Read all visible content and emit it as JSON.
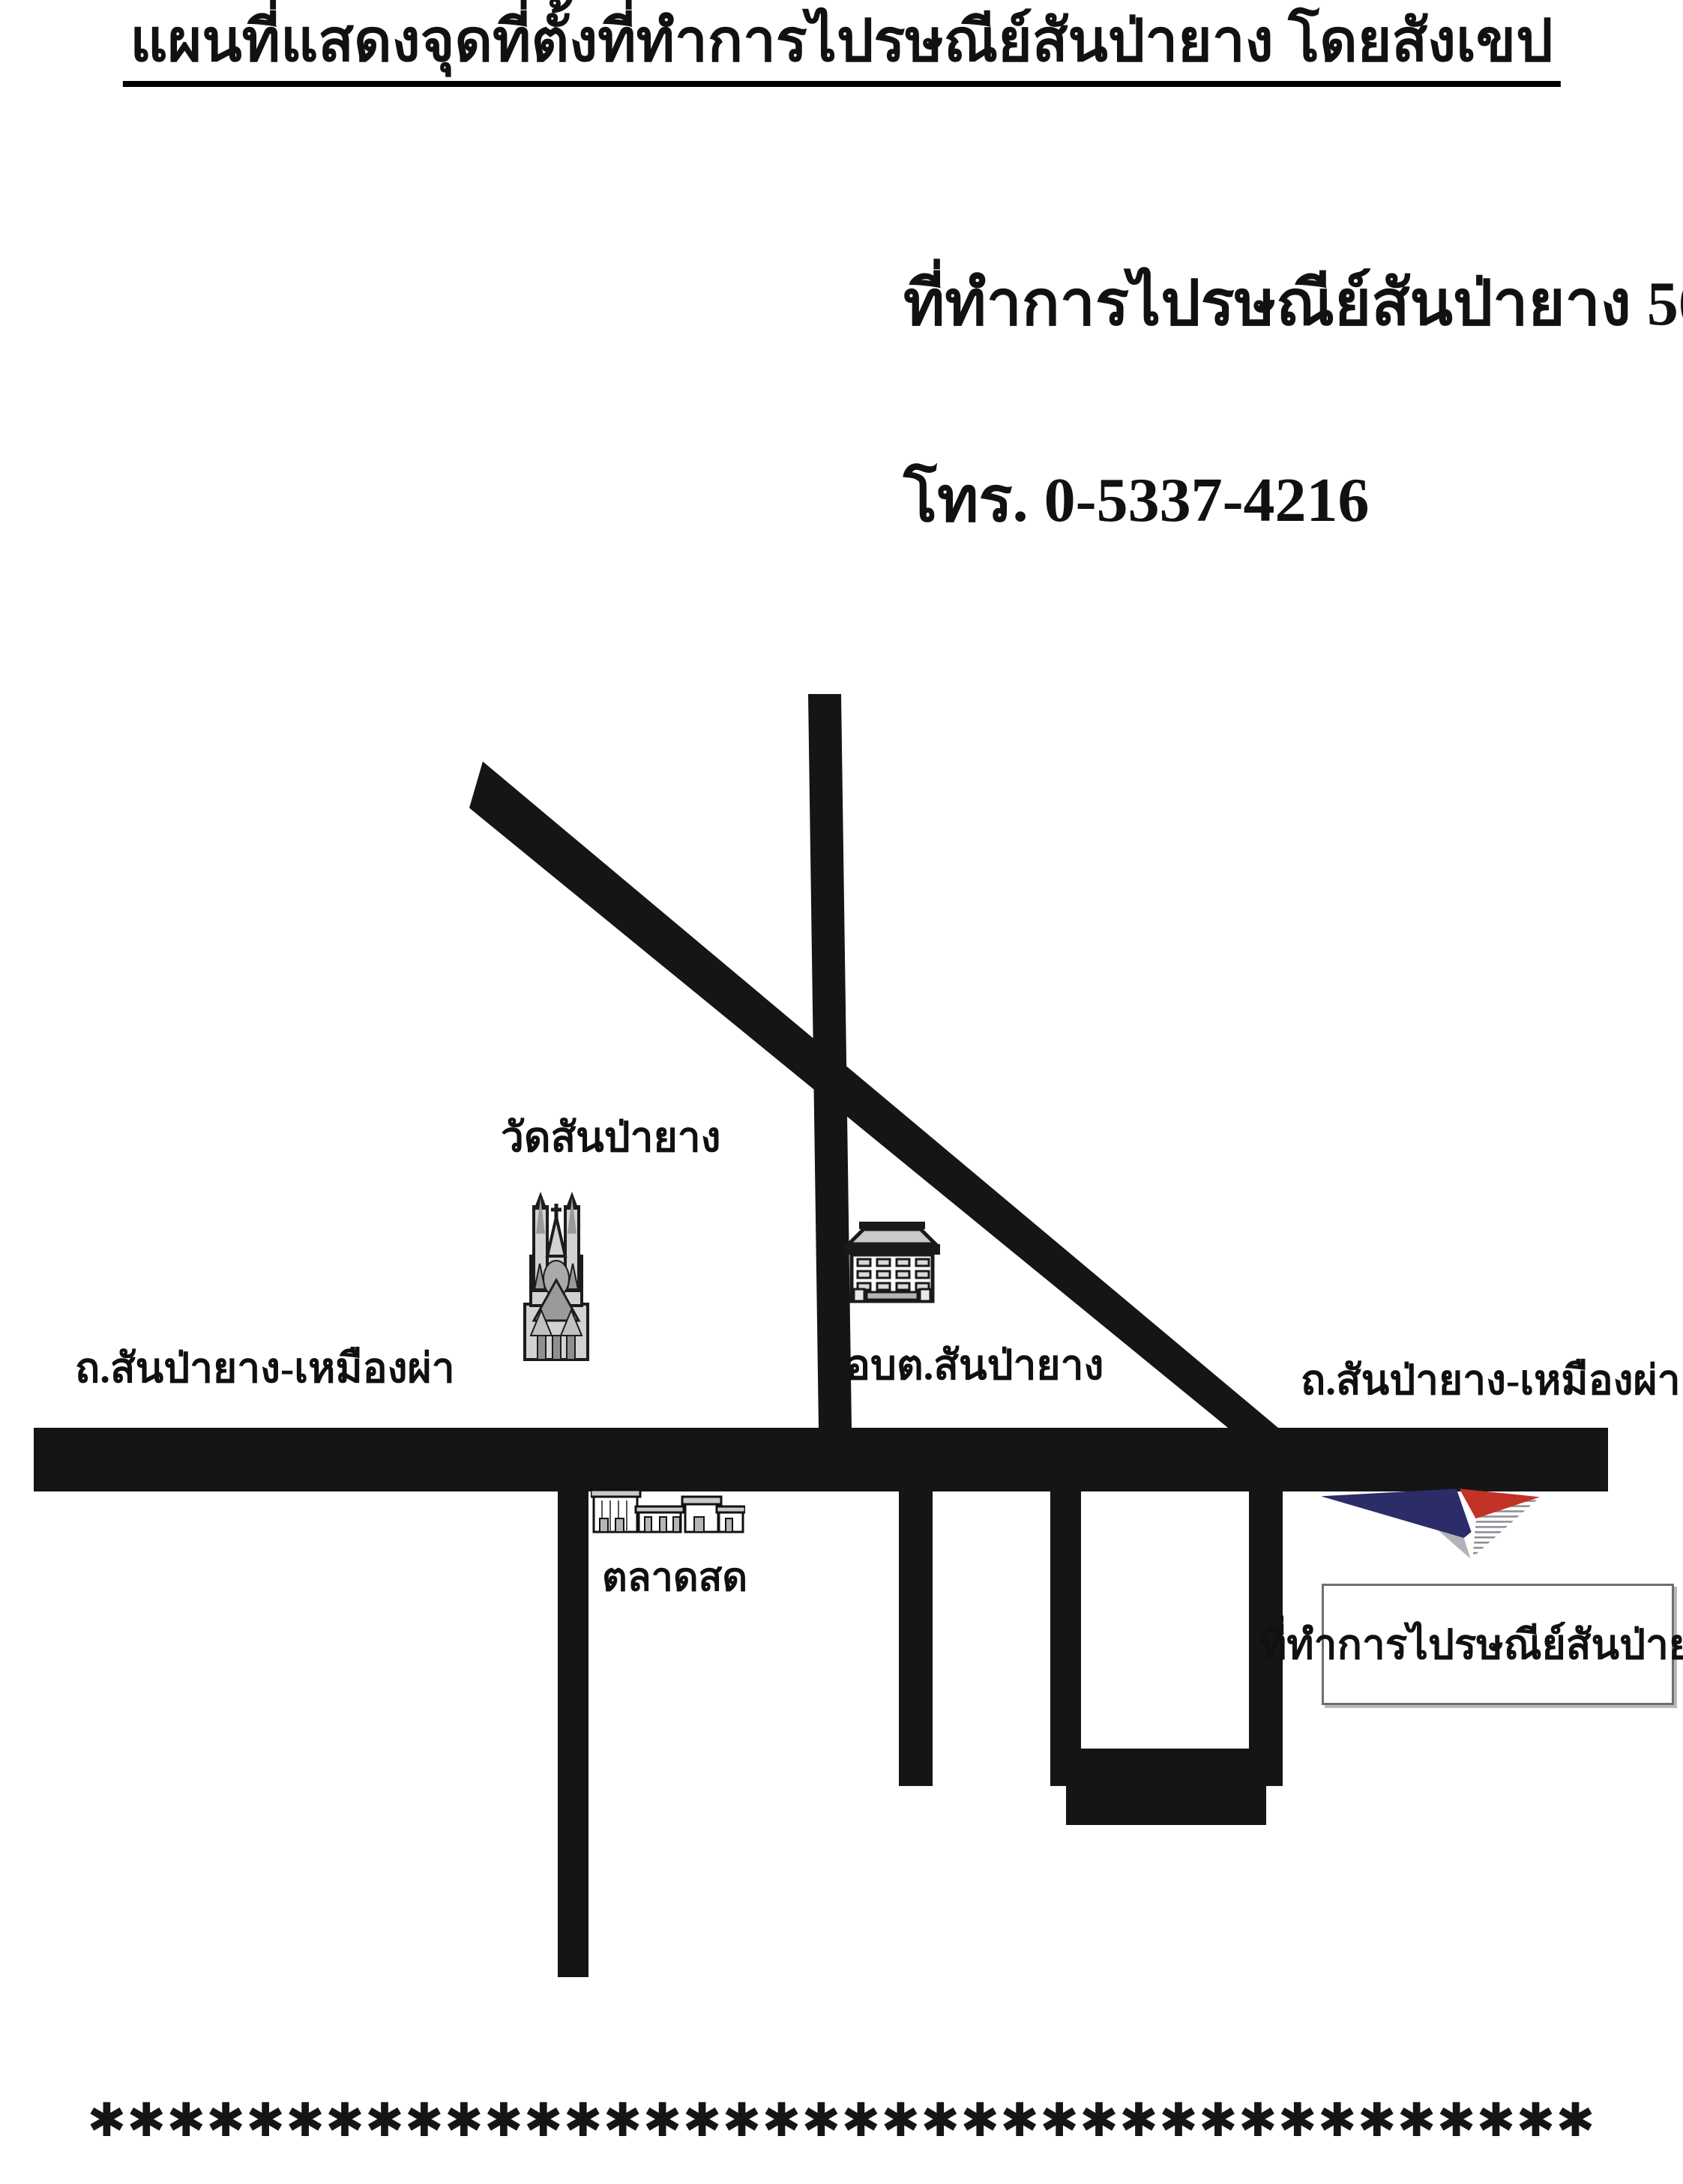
{
  "title": {
    "text": "แผนที่แสดงจุดที่ตั้งที่ทำการไปรษณีย์สันป่ายาง โดยสังเขป"
  },
  "contact": {
    "name_line": "ที่ทำการไปรษณีย์สันป่ายาง 50330",
    "phone_line": "โทร. 0-5337-4216"
  },
  "map": {
    "labels": {
      "temple": "วัดสันป่ายาง",
      "road_left": "ถ.สันป่ายาง-เหมืองผ่า",
      "sao": "อบต.สันป่ายาง",
      "market": "ตลาดสด",
      "road_right": "ถ.สันป่ายาง-เหมืองผ่า"
    }
  },
  "post_office_box": {
    "label": "ที่ทำการไปรษณีย์สันป่ายาง"
  },
  "footer": {
    "asterisks": "✱✱✱✱✱✱✱✱✱✱✱✱✱✱✱✱✱✱✱✱✱✱✱✱✱✱✱✱✱✱✱✱✱✱✱✱✱✱"
  },
  "colors": {
    "road": "#151515",
    "logo_navy": "#2c2c68",
    "logo_red": "#c23227",
    "logo_gray": "#b2b2ba"
  }
}
